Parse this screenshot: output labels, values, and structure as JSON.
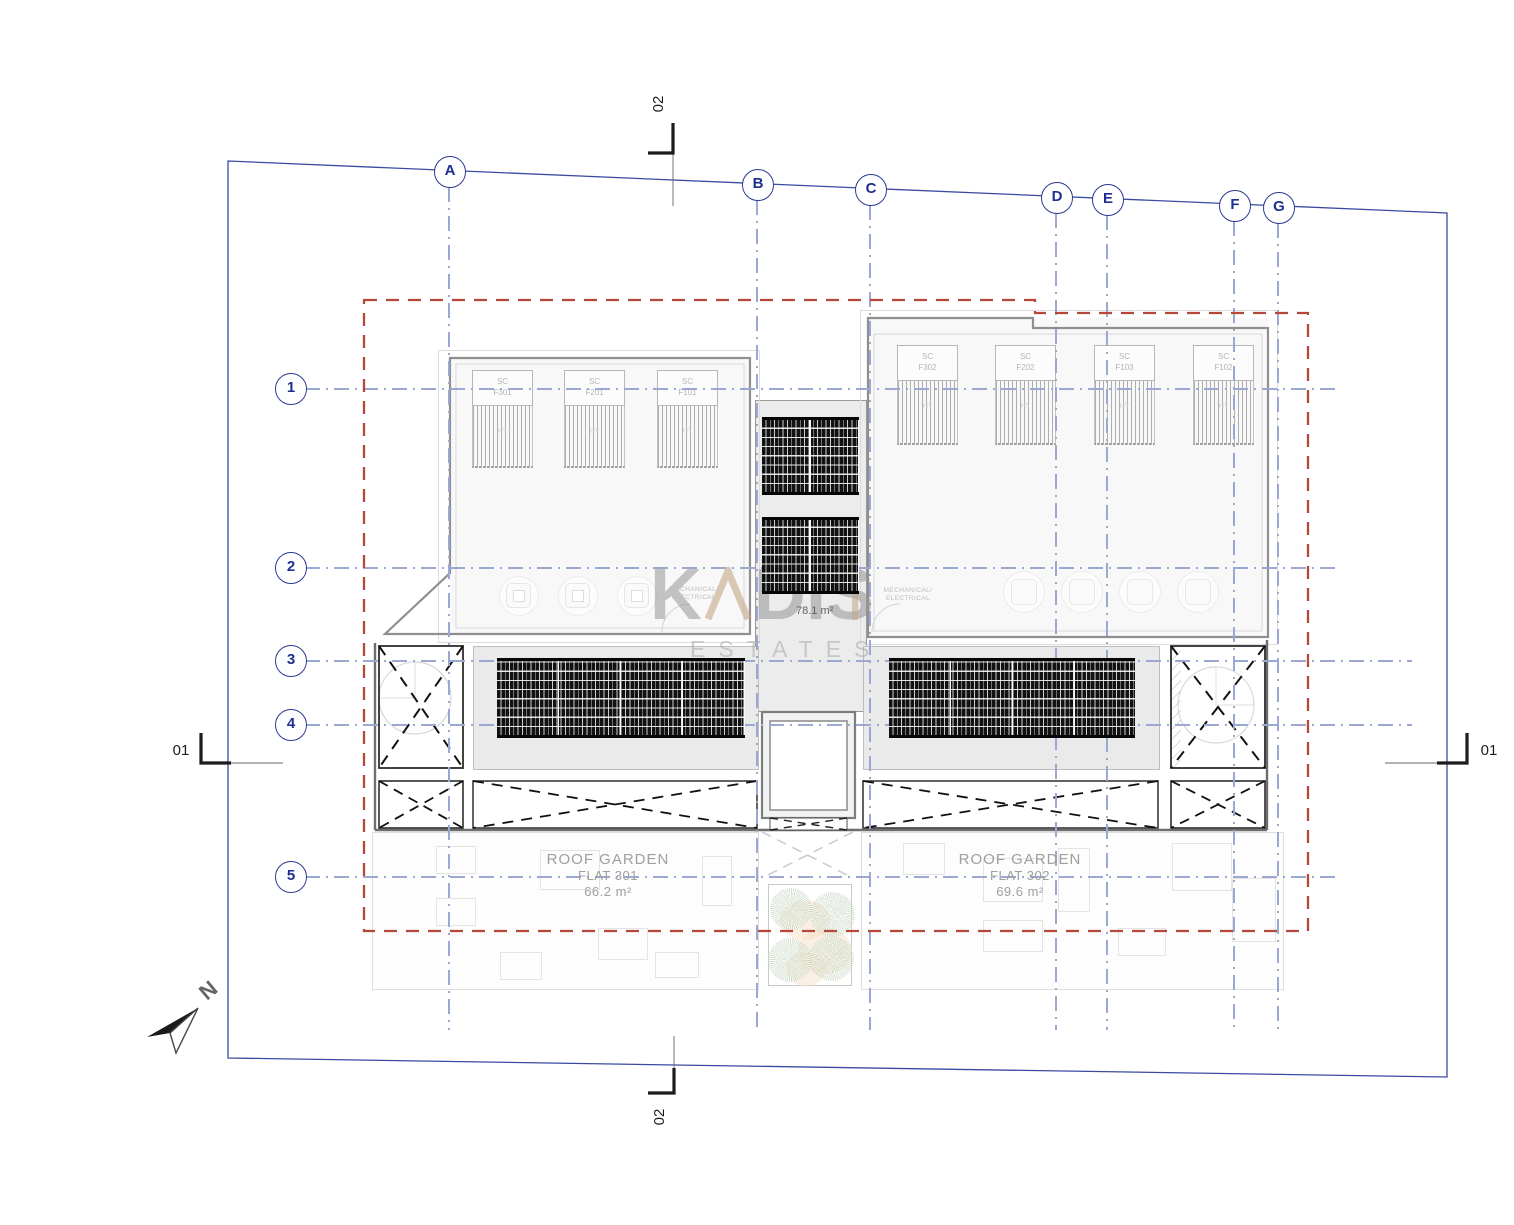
{
  "page": {
    "background": "#ffffff"
  },
  "grid": {
    "cols": [
      {
        "label": "A"
      },
      {
        "label": "B"
      },
      {
        "label": "C"
      },
      {
        "label": "D"
      },
      {
        "label": "E"
      },
      {
        "label": "F"
      },
      {
        "label": "G"
      }
    ],
    "rows": [
      {
        "label": "1"
      },
      {
        "label": "2"
      },
      {
        "label": "3"
      },
      {
        "label": "4"
      },
      {
        "label": "5"
      }
    ]
  },
  "sections": {
    "top": "02",
    "bottom": "02",
    "left": "01",
    "right": "01"
  },
  "collectors": {
    "prefix": "SC",
    "ht": "HT",
    "units": [
      {
        "code": "F301"
      },
      {
        "code": "F201"
      },
      {
        "code": "F101"
      },
      {
        "code": "F302"
      },
      {
        "code": "F202"
      },
      {
        "code": "F103"
      },
      {
        "code": "F102"
      }
    ]
  },
  "plant": {
    "mech_line1": "MECHANICAL/",
    "mech_line2": "ELECTRICAL",
    "central_area": "78.1 m²"
  },
  "gardens": [
    {
      "title": "ROOF GARDEN",
      "flat": "FLAT 301",
      "area": "66.2 m²"
    },
    {
      "title": "ROOF GARDEN",
      "flat": "FLAT 302",
      "area": "69.6 m²"
    }
  ],
  "watermark": {
    "k": "K",
    "dis": "DIS",
    "estates": "ESTATES"
  },
  "north": {
    "label": "N"
  },
  "colors": {
    "grid_blue": "#1d3091",
    "line_blue": "#9aa8d2",
    "boundary_red": "#b5483a",
    "border_blue": "#3a4aa0",
    "panel_dark": "#121212"
  }
}
